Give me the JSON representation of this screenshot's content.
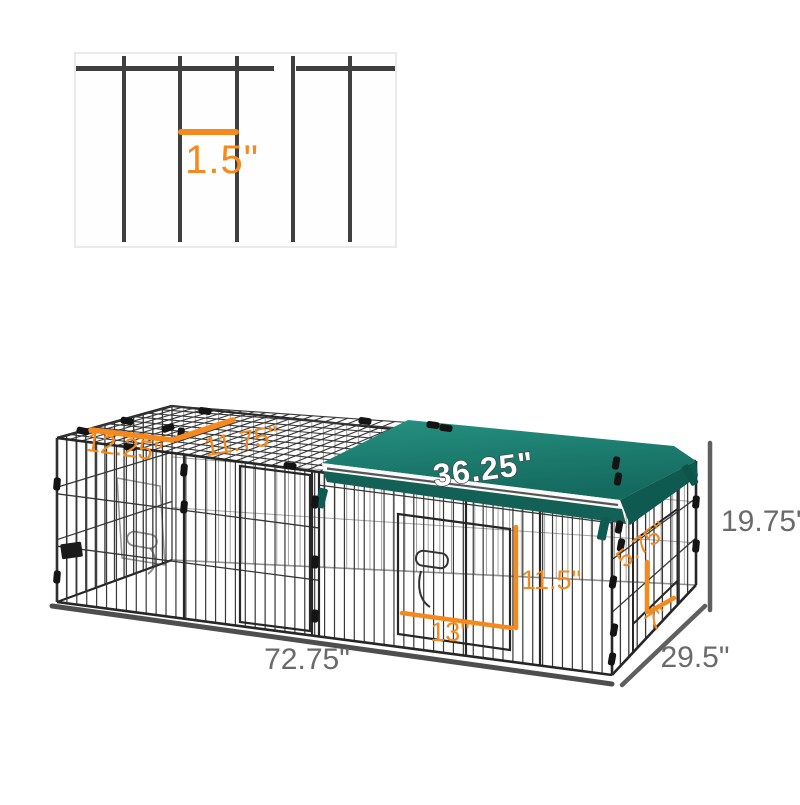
{
  "inset": {
    "wire_spacing_label": "1.5\""
  },
  "dimensions": {
    "roof_panel_left": "12.25\"",
    "roof_panel_right": "11.75\"",
    "cover_length": "36.25\"",
    "overall_height": "19.75\"",
    "overall_depth": "29.5\"",
    "overall_length": "72.75\"",
    "front_door_height": "11.5\"",
    "front_door_width": "13\"",
    "side_door_height": "5.75\"",
    "side_door_width": "7\""
  },
  "colors": {
    "accent_orange": "#f5891e",
    "dimension_gray": "#6a6a6a",
    "cover_green": "#1c7d6f",
    "cover_green_dark": "#136156",
    "wire_dark": "#383838"
  }
}
